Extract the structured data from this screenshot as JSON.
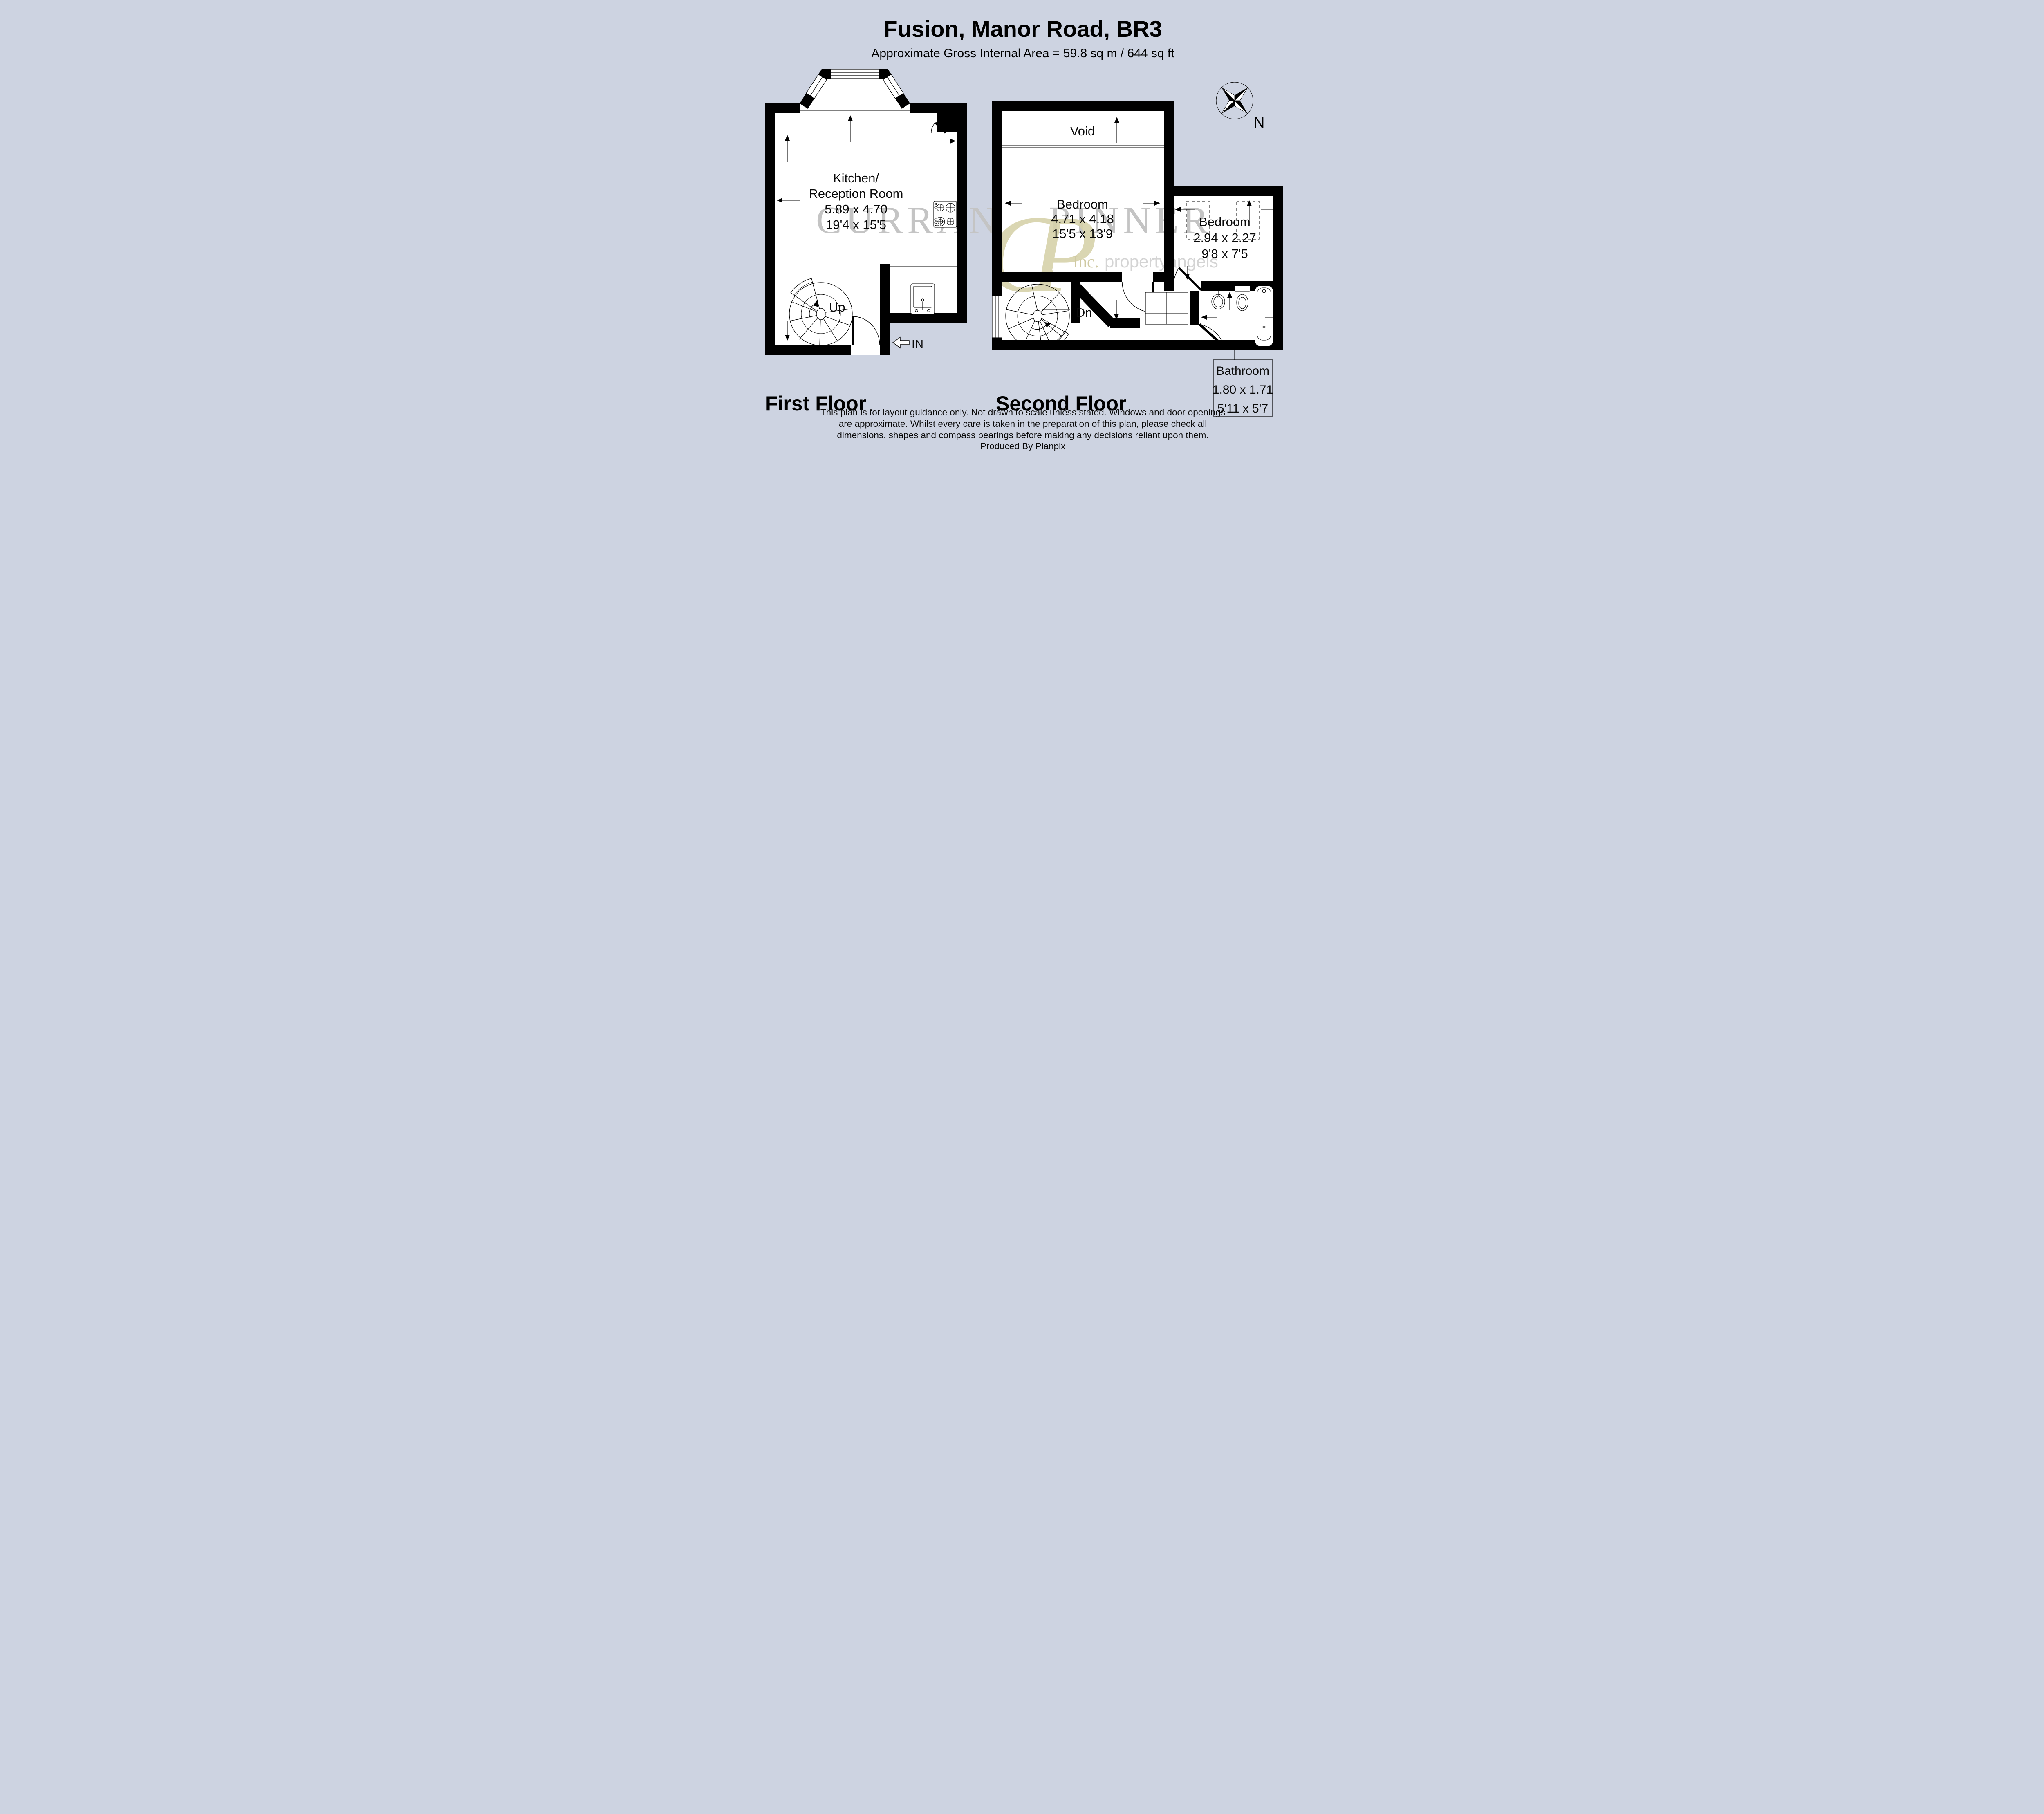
{
  "header": {
    "title": "Fusion, Manor Road, BR3",
    "subtitle": "Approximate Gross Internal Area = 59.8 sq m / 644 sq ft"
  },
  "first_floor": {
    "label": "First Floor",
    "kitchen_reception": {
      "name_line1": "Kitchen/",
      "name_line2": "Reception Room",
      "metric": "5.89 x 4.70",
      "imperial": "19'4 x 15'5"
    },
    "stairs": "Up",
    "entrance": "IN"
  },
  "second_floor": {
    "label": "Second Floor",
    "void": "Void",
    "bedroom_main": {
      "name": "Bedroom",
      "metric": "4.71 x 4.18",
      "imperial": "15'5 x 13'9"
    },
    "bedroom_second": {
      "name": "Bedroom",
      "metric": "2.94 x 2.27",
      "imperial": "9'8 x 7'5"
    },
    "bathroom": {
      "name": "Bathroom",
      "metric": "1.80 x 1.71",
      "imperial": "5'11 x 5'7"
    },
    "stairs": "Dn"
  },
  "compass": {
    "north": "N"
  },
  "watermark": {
    "word_left": "CURRAN",
    "monogram": "CP",
    "word_right": "PINNER",
    "inc": "Inc.",
    "brand": "propertyangels"
  },
  "footer": {
    "disclaimer": [
      "This plan is for layout guidance only. Not drawn to scale unless stated. Windows and door openings",
      "are approximate. Whilst every care is taken in the preparation of this plan, please check all",
      "dimensions, shapes and compass bearings before making any decisions reliant upon them."
    ],
    "credit": "Produced By Planpix"
  },
  "colors": {
    "background": "#cdd3e1",
    "wall": "#000000",
    "floor": "#ffffff",
    "watermark_gray": "#c4c4c4",
    "watermark_beige": "#d6d2aa"
  }
}
